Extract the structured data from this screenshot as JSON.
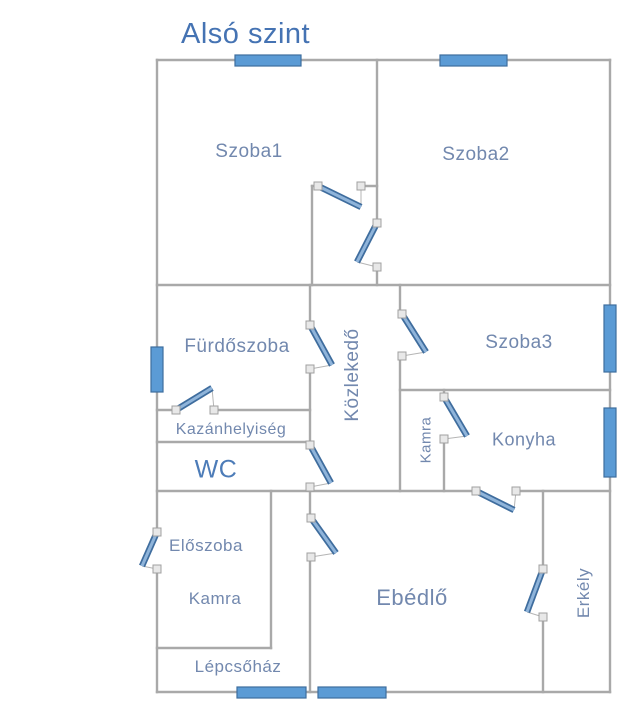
{
  "title": {
    "text": "Alsó szint"
  },
  "canvas": {
    "width": 631,
    "height": 722
  },
  "colors": {
    "wall": "#a9a9a9",
    "window_fill": "#5b9bd5",
    "window_stroke": "#3e6d9e",
    "door_leaf_dark": "#3f6d9e",
    "door_leaf_light": "#8fb4da",
    "hinge_fill": "#e8e8e8",
    "hinge_stroke": "#a0a0a0",
    "chord": "#b5b5b5",
    "label_default": "#7288ae",
    "title_color": "#4573b3"
  },
  "rooms": [
    {
      "id": "szoba1",
      "label": "Szoba1",
      "x": 249,
      "y": 152,
      "size": 19,
      "rotate": 0
    },
    {
      "id": "szoba2",
      "label": "Szoba2",
      "x": 476,
      "y": 155,
      "size": 19,
      "rotate": 0
    },
    {
      "id": "furdoszoba",
      "label": "Fürdőszoba",
      "x": 237,
      "y": 347,
      "size": 19,
      "rotate": 0
    },
    {
      "id": "kozlekedo",
      "label": "Közlekedő",
      "x": 353,
      "y": 375,
      "size": 19,
      "rotate": -90
    },
    {
      "id": "szoba3",
      "label": "Szoba3",
      "x": 519,
      "y": 343,
      "size": 19,
      "rotate": 0
    },
    {
      "id": "kazanhelyiseg",
      "label": "Kazánhelyiség",
      "x": 231,
      "y": 430,
      "size": 16,
      "rotate": 0
    },
    {
      "id": "kamra-felso",
      "label": "Kamra",
      "x": 426,
      "y": 440,
      "size": 15,
      "rotate": -90
    },
    {
      "id": "konyha",
      "label": "Konyha",
      "x": 524,
      "y": 440,
      "size": 18,
      "rotate": 0
    },
    {
      "id": "wc",
      "label": "WC",
      "x": 216,
      "y": 470,
      "size": 25,
      "rotate": 0,
      "color": "#4d7cb8"
    },
    {
      "id": "eloszoba",
      "label": "Előszoba",
      "x": 206,
      "y": 546,
      "size": 17,
      "rotate": 0
    },
    {
      "id": "kamra-also",
      "label": "Kamra",
      "x": 215,
      "y": 599,
      "size": 17,
      "rotate": 0
    },
    {
      "id": "ebedlo",
      "label": "Ebédlő",
      "x": 412,
      "y": 598,
      "size": 22,
      "rotate": 0
    },
    {
      "id": "erkely",
      "label": "Erkély",
      "x": 584,
      "y": 593,
      "size": 17,
      "rotate": -90
    },
    {
      "id": "lepcsohaz",
      "label": "Lépcsőház",
      "x": 238,
      "y": 667,
      "size": 17,
      "rotate": 0
    }
  ],
  "walls": [
    [
      157,
      60,
      610,
      60
    ],
    [
      157,
      60,
      157,
      532
    ],
    [
      157,
      570,
      157,
      692
    ],
    [
      610,
      60,
      610,
      692
    ],
    [
      157,
      692,
      610,
      692
    ],
    [
      377,
      60,
      377,
      222
    ],
    [
      377,
      268,
      377,
      285
    ],
    [
      312,
      186,
      312,
      285
    ],
    [
      312,
      186,
      319,
      186
    ],
    [
      361,
      186,
      377,
      186
    ],
    [
      157,
      285,
      610,
      285
    ],
    [
      310,
      285,
      310,
      324
    ],
    [
      310,
      370,
      310,
      444
    ],
    [
      310,
      488,
      310,
      517
    ],
    [
      310,
      558,
      310,
      692
    ],
    [
      400,
      285,
      400,
      313
    ],
    [
      400,
      357,
      400,
      491
    ],
    [
      157,
      410,
      175,
      410
    ],
    [
      215,
      410,
      310,
      410
    ],
    [
      157,
      442,
      310,
      442
    ],
    [
      157,
      491,
      475,
      491
    ],
    [
      517,
      491,
      610,
      491
    ],
    [
      400,
      390,
      610,
      390
    ],
    [
      444,
      390,
      444,
      397
    ],
    [
      444,
      440,
      444,
      491
    ],
    [
      271,
      491,
      271,
      648
    ],
    [
      157,
      648,
      271,
      648
    ],
    [
      543,
      491,
      543,
      566
    ],
    [
      543,
      618,
      543,
      692
    ]
  ],
  "windows": [
    {
      "id": "szoba1-ablak",
      "x": 235,
      "y": 55,
      "w": 66,
      "h": 11
    },
    {
      "id": "szoba2-ablak",
      "x": 440,
      "y": 55,
      "w": 67,
      "h": 11
    },
    {
      "id": "furdoszoba-ablak",
      "x": 151,
      "y": 347,
      "w": 12,
      "h": 45
    },
    {
      "id": "szoba3-ablak",
      "x": 604,
      "y": 305,
      "w": 12,
      "h": 67
    },
    {
      "id": "konyha-ablak",
      "x": 604,
      "y": 408,
      "w": 12,
      "h": 69
    },
    {
      "id": "lepcsohaz-ablak",
      "x": 237,
      "y": 687,
      "w": 69,
      "h": 11
    },
    {
      "id": "ebedlo-ablak",
      "x": 318,
      "y": 687,
      "w": 68,
      "h": 11
    }
  ],
  "doors": [
    {
      "id": "szoba1-ajto",
      "hinge": [
        318,
        186
      ],
      "jamb": [
        361,
        186
      ],
      "tip": [
        361,
        207
      ]
    },
    {
      "id": "szoba2-ajto",
      "hinge": [
        377,
        223
      ],
      "jamb": [
        377,
        267
      ],
      "tip": [
        357,
        262
      ]
    },
    {
      "id": "furdoszoba-ajto",
      "hinge": [
        310,
        325
      ],
      "jamb": [
        310,
        369
      ],
      "tip": [
        332,
        365
      ]
    },
    {
      "id": "kazanhelyiseg-ajto",
      "hinge": [
        176,
        410
      ],
      "jamb": [
        214,
        410
      ],
      "tip": [
        212,
        388
      ]
    },
    {
      "id": "wc-ajto",
      "hinge": [
        310,
        445
      ],
      "jamb": [
        310,
        487
      ],
      "tip": [
        331,
        483
      ]
    },
    {
      "id": "szoba3-ajto",
      "hinge": [
        402,
        314
      ],
      "jamb": [
        402,
        356
      ],
      "tip": [
        426,
        352
      ]
    },
    {
      "id": "kamra-konyha-ajto",
      "hinge": [
        444,
        397
      ],
      "jamb": [
        444,
        439
      ],
      "tip": [
        467,
        436
      ]
    },
    {
      "id": "konyha-ebedlo-ajto",
      "hinge": [
        476,
        491
      ],
      "jamb": [
        516,
        491
      ],
      "tip": [
        514,
        510
      ]
    },
    {
      "id": "ebedlo-ajto",
      "hinge": [
        311,
        518
      ],
      "jamb": [
        311,
        557
      ],
      "tip": [
        336,
        553
      ]
    },
    {
      "id": "bejarati-ajto",
      "hinge": [
        157,
        532
      ],
      "jamb": [
        157,
        569
      ],
      "tip": [
        142,
        566
      ]
    },
    {
      "id": "erkely-ajto",
      "hinge": [
        543,
        569
      ],
      "jamb": [
        543,
        617
      ],
      "tip": [
        527,
        612
      ]
    }
  ]
}
